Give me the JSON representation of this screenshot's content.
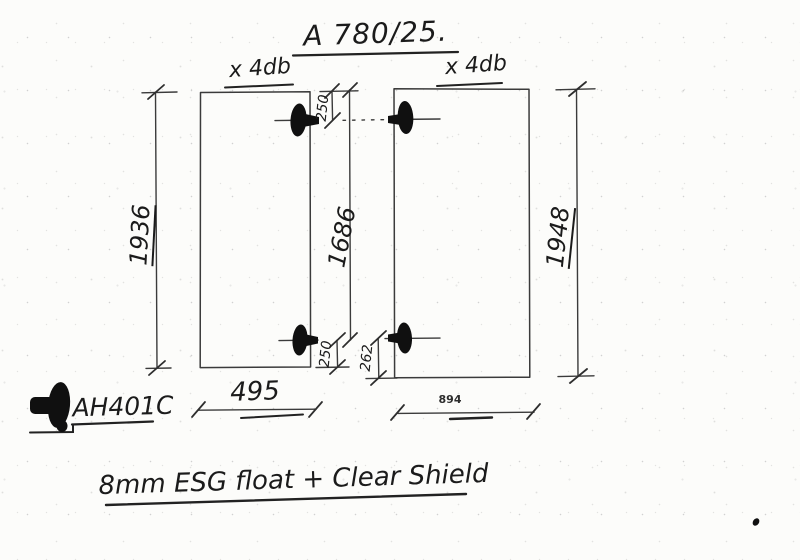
{
  "title": "A 780/25.",
  "panels": {
    "left": {
      "qty_label": "x 4db",
      "height": "1936",
      "width": "495",
      "hole_top_offset": "250",
      "hole_bottom_offset": "250"
    },
    "right": {
      "qty_label": "x 4db",
      "height": "1948",
      "width": "894",
      "hole_bottom_offset": "262"
    }
  },
  "dims": {
    "top_to_bottom_hole": "1686"
  },
  "fitting": {
    "code": "AH401C",
    "icon": "point-fixing-side-view-icon"
  },
  "spec_note": "8mm ESG float + Clear Shield",
  "colors": {
    "ink": "#3b3b3b",
    "fitting_fill": "#101010",
    "paper": "#fcfcfa"
  }
}
